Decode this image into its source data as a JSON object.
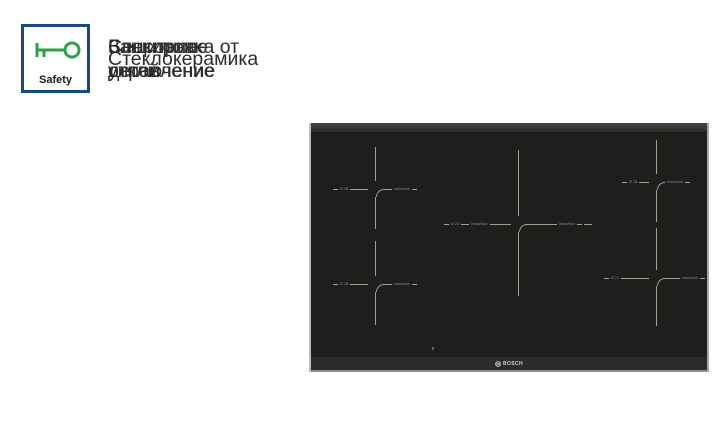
{
  "features": [
    {
      "badge": "CERAMIC",
      "label_lines": [
        "Стеклокерамика"
      ]
    },
    {
      "badge": "AutoOff",
      "label_lines": [
        "Защитное",
        "отключение"
      ]
    },
    {
      "badge": "",
      "label_lines": [
        "Сенсорное",
        "управление"
      ]
    },
    {
      "badge": "Safety",
      "label_lines": [
        "Блокировка от",
        "детей"
      ]
    }
  ],
  "cooktop": {
    "brand": "BOSCH",
    "zones": [
      {
        "position": "top-left",
        "left_label": "Ø 18",
        "right_label": "induction"
      },
      {
        "position": "bottom-left",
        "left_label": "Ø 18",
        "right_label": "induction"
      },
      {
        "position": "center",
        "left_label": "Ø 21",
        "left_label_2": "induction",
        "right_label": "induction"
      },
      {
        "position": "top-right",
        "left_label": "Ø 18",
        "right_label": "induction"
      },
      {
        "position": "bottom-right",
        "left_label": "Ø 21",
        "right_label": "induction"
      }
    ]
  },
  "colors": {
    "badge_border_blue": "#17498e",
    "green": "#2ba63e",
    "red": "#f25048",
    "ring_taupe": "#8b8170",
    "cooktop_surface": "#201e1d",
    "background": "#ffffff"
  }
}
